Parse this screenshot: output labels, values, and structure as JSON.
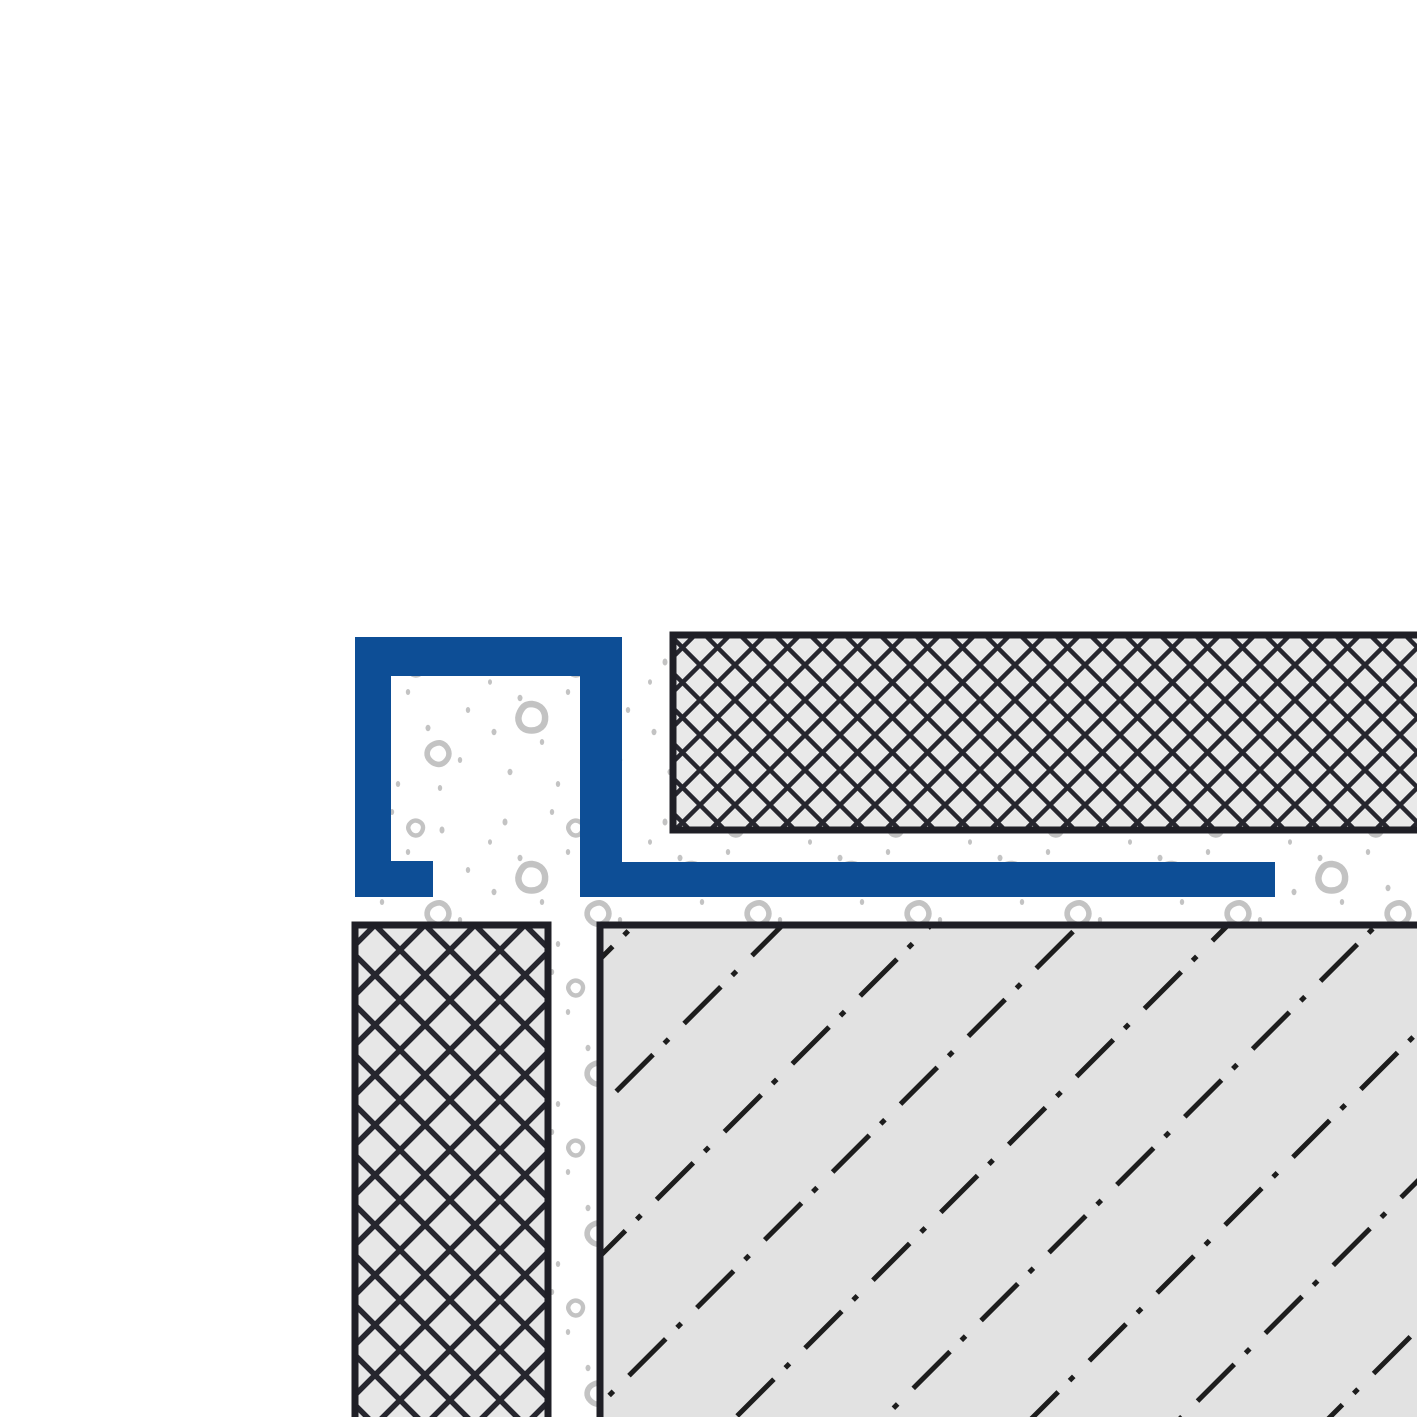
{
  "meta": {
    "title": "Tile edge profile — installation cross-section"
  },
  "colors": {
    "background": "#ffffff",
    "profile_blue": "#0d4e96",
    "border_dark": "#1f1f26",
    "hatch_dark": "#26262e",
    "dashdot_dark": "#1d1d1d",
    "tile_top_fill": "#e9e9e9",
    "tile_left_fill": "#e7e7e7",
    "substrate_fill": "#e2e2e2",
    "mortar_bg": "#ffffff",
    "speckle_gray": "#c3c3c3"
  }
}
